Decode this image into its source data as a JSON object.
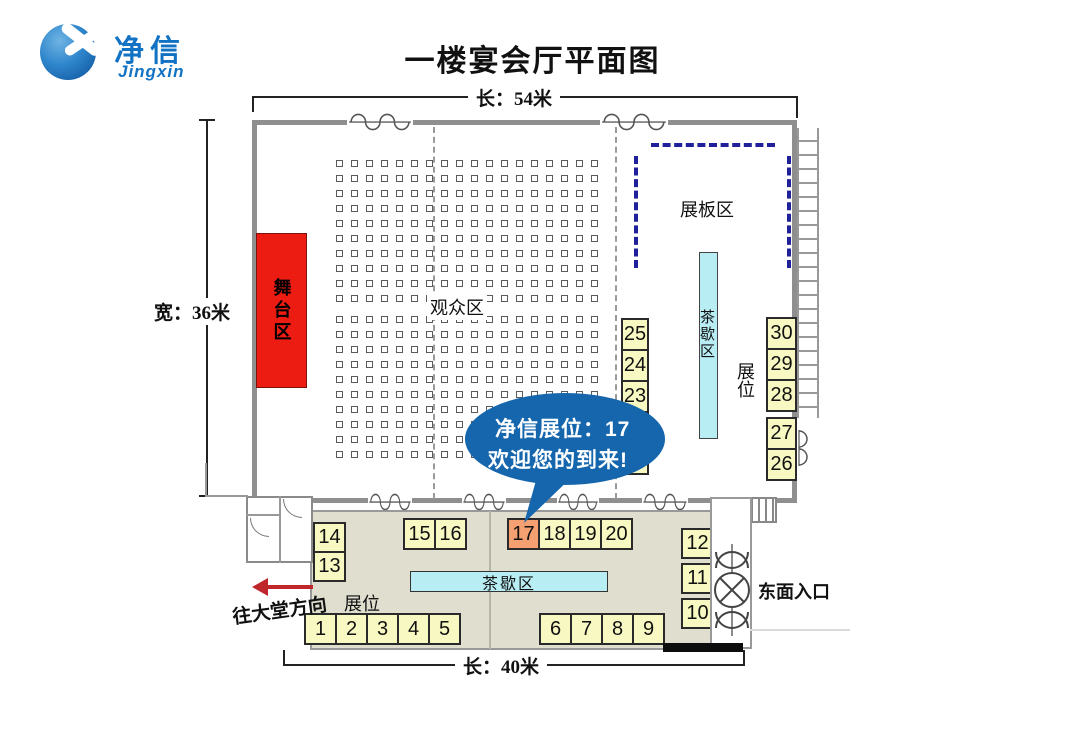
{
  "logo": {
    "brand_cn": "净信",
    "brand_en": "Jingxin"
  },
  "title": "一楼宴会厅平面图",
  "dimensions": {
    "top": "长：54米",
    "left": "宽：36米",
    "bottom": "长：40米"
  },
  "hall": {
    "stage_label": "舞台区",
    "audience_label": "观众区",
    "display_board_label": "展板区",
    "tea_area_vertical_label": "茶歇区",
    "booth_column_label": "展位",
    "audience_grid": {
      "cols": 18,
      "rows_top": 10,
      "rows_bottom": 10
    },
    "booths_left_column": [
      "25",
      "24",
      "23",
      "",
      ""
    ],
    "booths_right_column_upper": [
      "30",
      "29",
      "28"
    ],
    "booths_right_column_lower": [
      "27",
      "26"
    ]
  },
  "foyer": {
    "tea_bar_label": "茶歇区",
    "booths_label": "展位",
    "booths_left_stack": [
      "14",
      "13"
    ],
    "booths_top_left": [
      "15",
      "16"
    ],
    "booths_top_right": [
      "17",
      "18",
      "19",
      "20"
    ],
    "booths_bottom_left": [
      "1",
      "2",
      "3",
      "4",
      "5"
    ],
    "booths_bottom_right": [
      "6",
      "7",
      "8",
      "9"
    ],
    "booths_right_stack": [
      "12",
      "11",
      "10"
    ],
    "highlighted_booth": "17"
  },
  "callout": {
    "line1": "净信展位：17",
    "line2": "欢迎您的到来!"
  },
  "annotations": {
    "east_entrance": "东面入口",
    "to_lobby": "往大堂方向"
  },
  "colors": {
    "booth_fill": "#f8f8c2",
    "booth_highlight": "#f5a071",
    "stage_red": "#ed1c13",
    "tea_cyan": "#b9edf4",
    "bubble_blue": "#1566ad",
    "board_dash_navy": "#20209a",
    "wall_gray": "#8f8f8f",
    "foyer_bg": "#e0decf",
    "arrow_red": "#c0272d",
    "logo_blue": "#1272c4"
  }
}
